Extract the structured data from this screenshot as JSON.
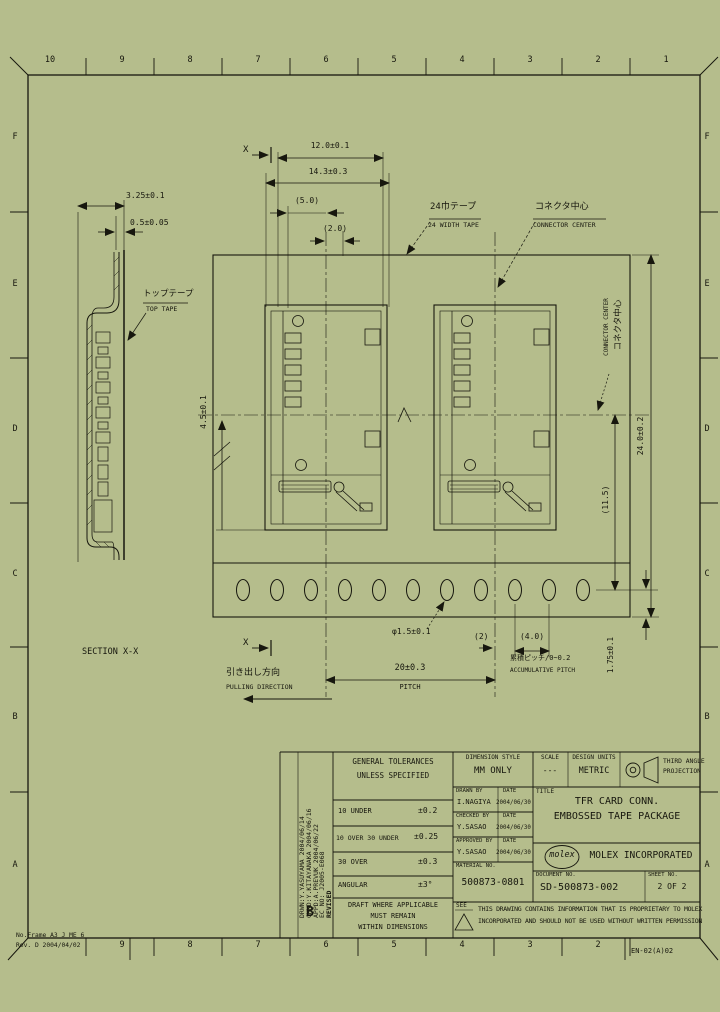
{
  "frame": {
    "zone_cols_top": [
      "10",
      "9",
      "8",
      "7",
      "6",
      "5",
      "4",
      "3",
      "2",
      "1"
    ],
    "zone_cols_bottom": [
      "9",
      "8",
      "7",
      "6",
      "5",
      "4",
      "3",
      "2"
    ],
    "zone_rows": [
      "F",
      "E",
      "D",
      "C",
      "B",
      "A"
    ],
    "corner_note_line1": "No.Frame A3 J ME 6",
    "corner_note_line2": "Rev. D 2004/04/02",
    "frame_ref": "EN-02(A)02"
  },
  "section_view": {
    "label": "SECTION X-X",
    "dim_emboss_height": "3.25±0.1",
    "dim_tape_thickness": "0.5±0.05",
    "top_tape_jp": "トップテープ",
    "top_tape_en": "TOP TAPE"
  },
  "plan_view": {
    "section_mark": "X",
    "dim_pocket_width": "12.0±0.1",
    "dim_emboss_width": "14.3±0.3",
    "dim_5": "(5.0)",
    "dim_2": "(2.0)",
    "tape_callout_jp": "24巾テープ",
    "tape_callout_en": "24 WIDTH TAPE",
    "center_callout_jp": "コネクタ中心",
    "center_callout_en": "CONNECTOR CENTER",
    "dim_tape_width": "24.0±0.2",
    "dim_f": "(11.5)",
    "dim_edge": "1.75±0.1",
    "dim_left": "4.5±0.1",
    "dim_sprocket_hole": "φ1.5±0.1",
    "dim_2b": "(2)",
    "dim_sprocket_pitch": "(4.0)",
    "cumulative_jp": "累積ピッチ/0~0.2",
    "cumulative_en": "ACCUMULATIVE PITCH",
    "dim_pitch": "20±0.3",
    "pitch_label": "PITCH",
    "pulling_jp": "引き出し方向",
    "pulling_en": "PULLING DIRECTION"
  },
  "title_block": {
    "revision": {
      "letter": "B",
      "lines": [
        "DRWN:Y.YASUYAMA 2004/06/14",
        "CHKD:Y.KITAYANAKA 2004/06/16",
        "APPD:A.PREVUK 2004/06/22",
        "EC NO: J2005-E068",
        "REVISED"
      ]
    },
    "tolerances": {
      "header1": "GENERAL TOLERANCES",
      "header2": "UNLESS SPECIFIED",
      "rows": [
        {
          "range": "10 UNDER",
          "value": "±0.2"
        },
        {
          "range": "10 OVER 30 UNDER",
          "value": "±0.25"
        },
        {
          "range": "30 OVER",
          "value": "±0.3"
        },
        {
          "range": "ANGULAR",
          "value": "±3°"
        }
      ],
      "note1": "DRAFT WHERE APPLICABLE",
      "note2": "MUST REMAIN",
      "note3": "WITHIN DIMENSIONS"
    },
    "dimension_style_label": "DIMENSION STYLE",
    "dimension_style_value": "MM ONLY",
    "drawn_by_label": "DRAWN BY",
    "drawn_by": "I.NAGIYA",
    "drawn_date_label": "DATE",
    "drawn_date": "2004/06/30",
    "checked_by_label": "CHECKED BY",
    "checked_by": "Y.SASAO",
    "checked_date_label": "DATE",
    "checked_date": "2004/06/30",
    "approved_by_label": "APPROVED BY",
    "approved_by": "Y.SASAO",
    "approved_date_label": "DATE",
    "approved_date": "2004/06/30",
    "material_label": "MATERIAL NO.",
    "material_no": "500873-0801",
    "scale_label": "SCALE",
    "scale_value": "---",
    "units_label": "DESIGN UNITS",
    "units_value": "METRIC",
    "projection_label1": "THIRD ANGLE",
    "projection_label2": "PROJECTION",
    "title_label": "TITLE",
    "title_line1": "TFR CARD CONN.",
    "title_line2": "EMBOSSED TAPE PACKAGE",
    "logo_text": "molex",
    "company": "MOLEX INCORPORATED",
    "document_label": "DOCUMENT NO.",
    "document_no": "SD-500873-002",
    "sheet_label": "SHEET NO.",
    "sheet_no": "2 OF 2",
    "see_note": "SEE",
    "disclaimer_line1": "THIS DRAWING CONTAINS INFORMATION THAT IS PROPRIETARY TO MOLEX",
    "disclaimer_line2": "INCORPORATED AND SHOULD NOT BE USED WITHOUT WRITTEN PERMISSION"
  }
}
